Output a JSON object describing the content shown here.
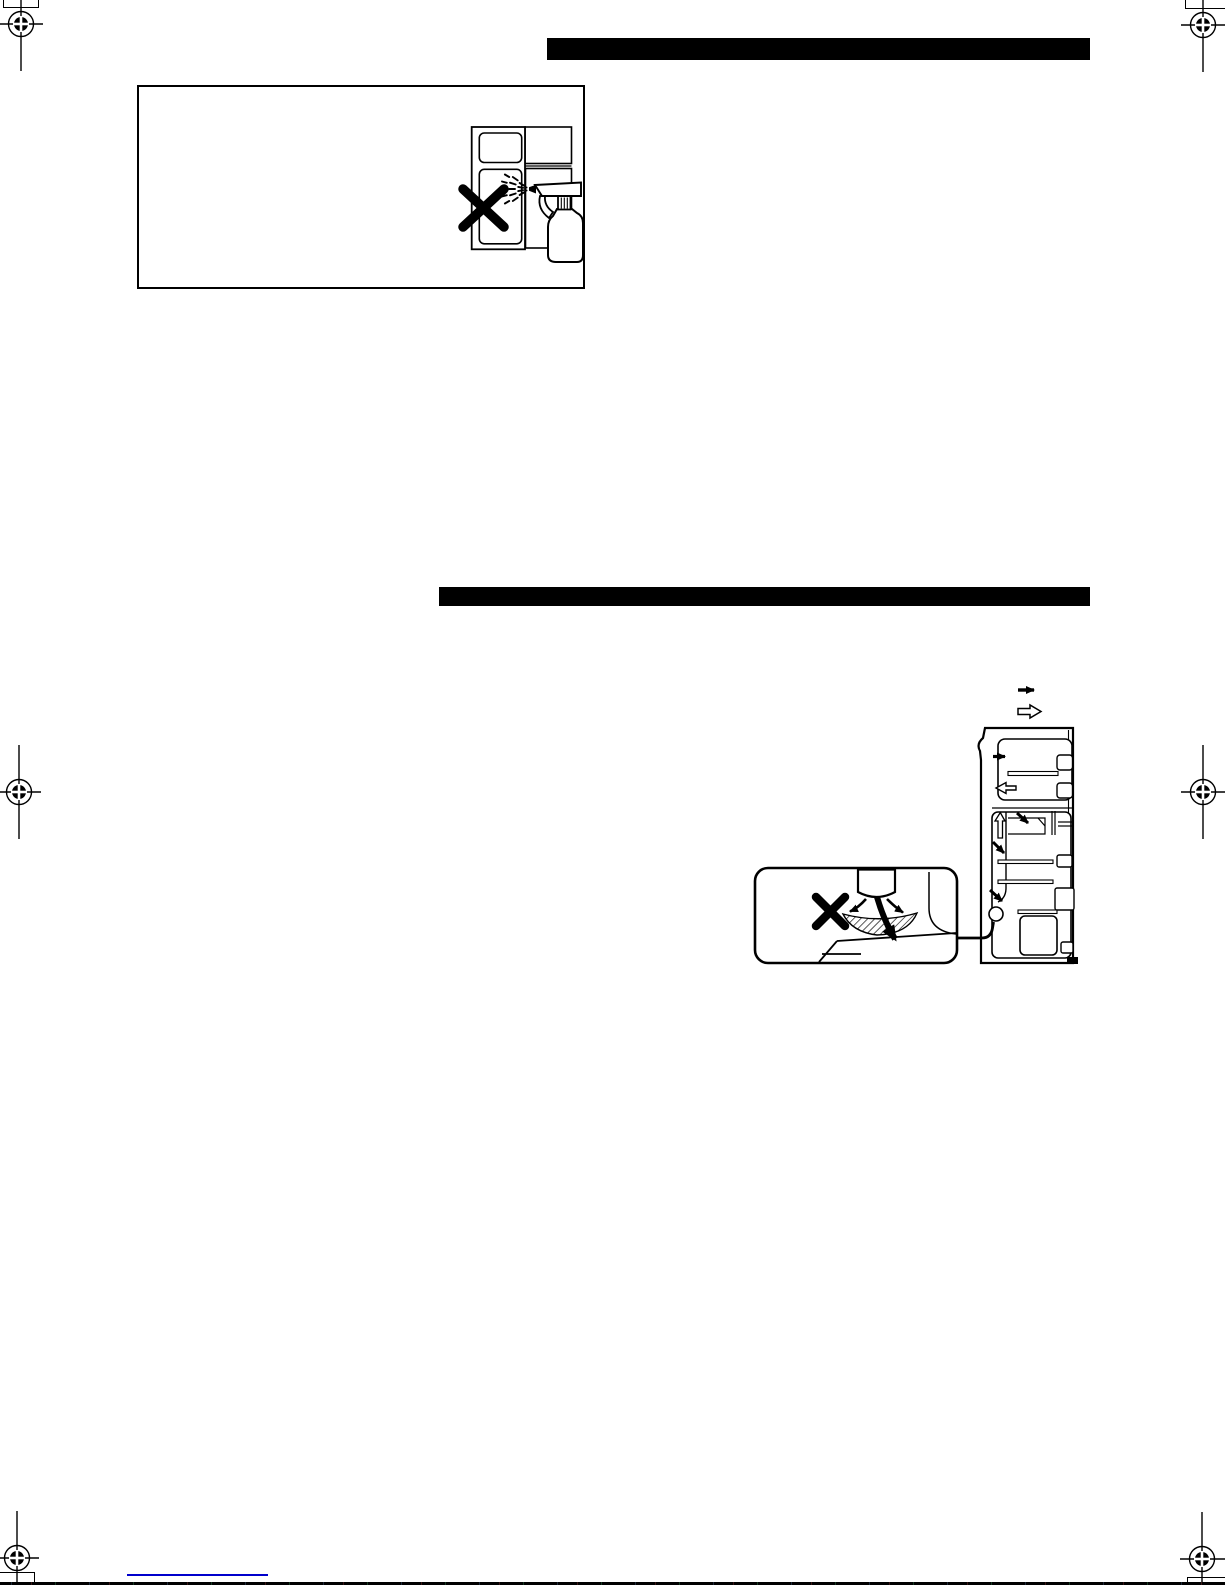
{
  "page": {
    "kind": "scanned-manual-page",
    "background": "#ffffff",
    "width_px": 1225,
    "height_px": 1585
  },
  "colors": {
    "ink": "#000000",
    "bar_fill": "#000000",
    "link_underline": "#0000cc",
    "paper": "#ffffff"
  },
  "header_bars": {
    "top_section_bar_text": "",
    "second_section_bar_text": ""
  },
  "illustrations": {
    "spray_warning": {
      "icon_names": [
        "refrigerator-front-icon",
        "prohibition-x-icon",
        "spray-bottle-icon",
        "water-mist-icon"
      ]
    },
    "airflow_diagram": {
      "icon_names": [
        "refrigerator-cross-section-icon",
        "cold-air-solid-arrow-icon",
        "return-air-hollow-arrow-icon",
        "shelf-icon",
        "door-bin-icon",
        "crisper-drawer-icon",
        "air-duct-icon"
      ],
      "legend_icons": [
        "solid-arrow-icon",
        "hollow-arrow-icon"
      ]
    },
    "vent_warning_inset": {
      "icon_names": [
        "air-vent-icon",
        "prohibition-x-icon",
        "curved-airflow-arrow-icon",
        "hatched-drain-pan-icon"
      ]
    }
  },
  "print_marks": {
    "registration_mark_count": 6,
    "corner_tick_box_count": 4
  },
  "footer": {
    "link_text": "",
    "link_underline_present": true
  }
}
